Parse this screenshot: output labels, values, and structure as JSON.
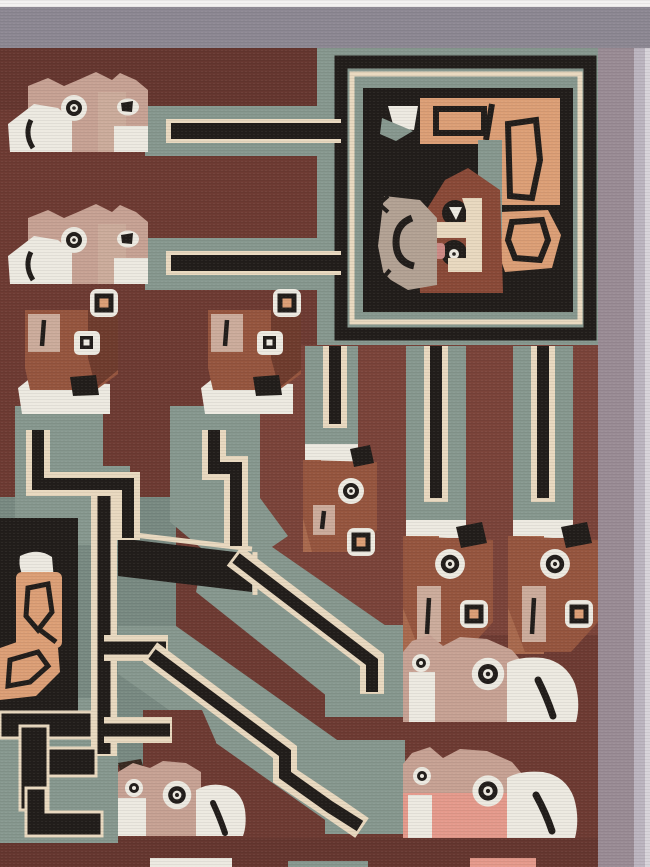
{
  "artwork": {
    "title": "Woven tapestry fragment with stylized animal heads",
    "alt": "Photograph of a hand-woven pile tapestry in Wari/Tiwanaku style: a maroon field bordered in grey-lavender, a black framed panel with an abstract face wearing a salmon headdress, rows of stylized llama-like animal heads, and stepped maze bands in sage green, black and cream.",
    "motifs": [
      "grey top border",
      "lavender right border",
      "framed deity-face panel with salmon headdress",
      "two left-facing animal heads with banded necks",
      "two downward animal heads with ring ornaments",
      "three hanging neck-bands with downward animal heads",
      "stepped maze of black-and-cream striped sage bands",
      "partial black panel with salmon scroll at left edge",
      "three right-facing animal heads with white muzzles at bottom"
    ]
  },
  "palette": {
    "paper": "#f3f1f1",
    "border_top": "#8d8893",
    "border_right": "#9a8c95",
    "border_right_light": "#bcb5c0",
    "border_edge": "#d8d4da",
    "maroon": "#6e3b33",
    "maroon_light": "#7b443a",
    "maroon_deep": "#663730",
    "sage": "#87988f",
    "sage_dark": "#798a82",
    "black": "#221e1b",
    "cream": "#e9d9c0",
    "white": "#edeae1",
    "salmon": "#dc9f76",
    "face_brown": "#8a4a38",
    "rust": "#96563f",
    "rust_dark": "#6f3c2e",
    "rust_light": "#a96a4e",
    "head_tan": "#c7a294",
    "tan_patch": "#ccac9c",
    "rose": "#e59a8c",
    "ear_gray": "#b3a294",
    "blush": "#cd8a85",
    "dark_brown": "#3a2b22"
  }
}
